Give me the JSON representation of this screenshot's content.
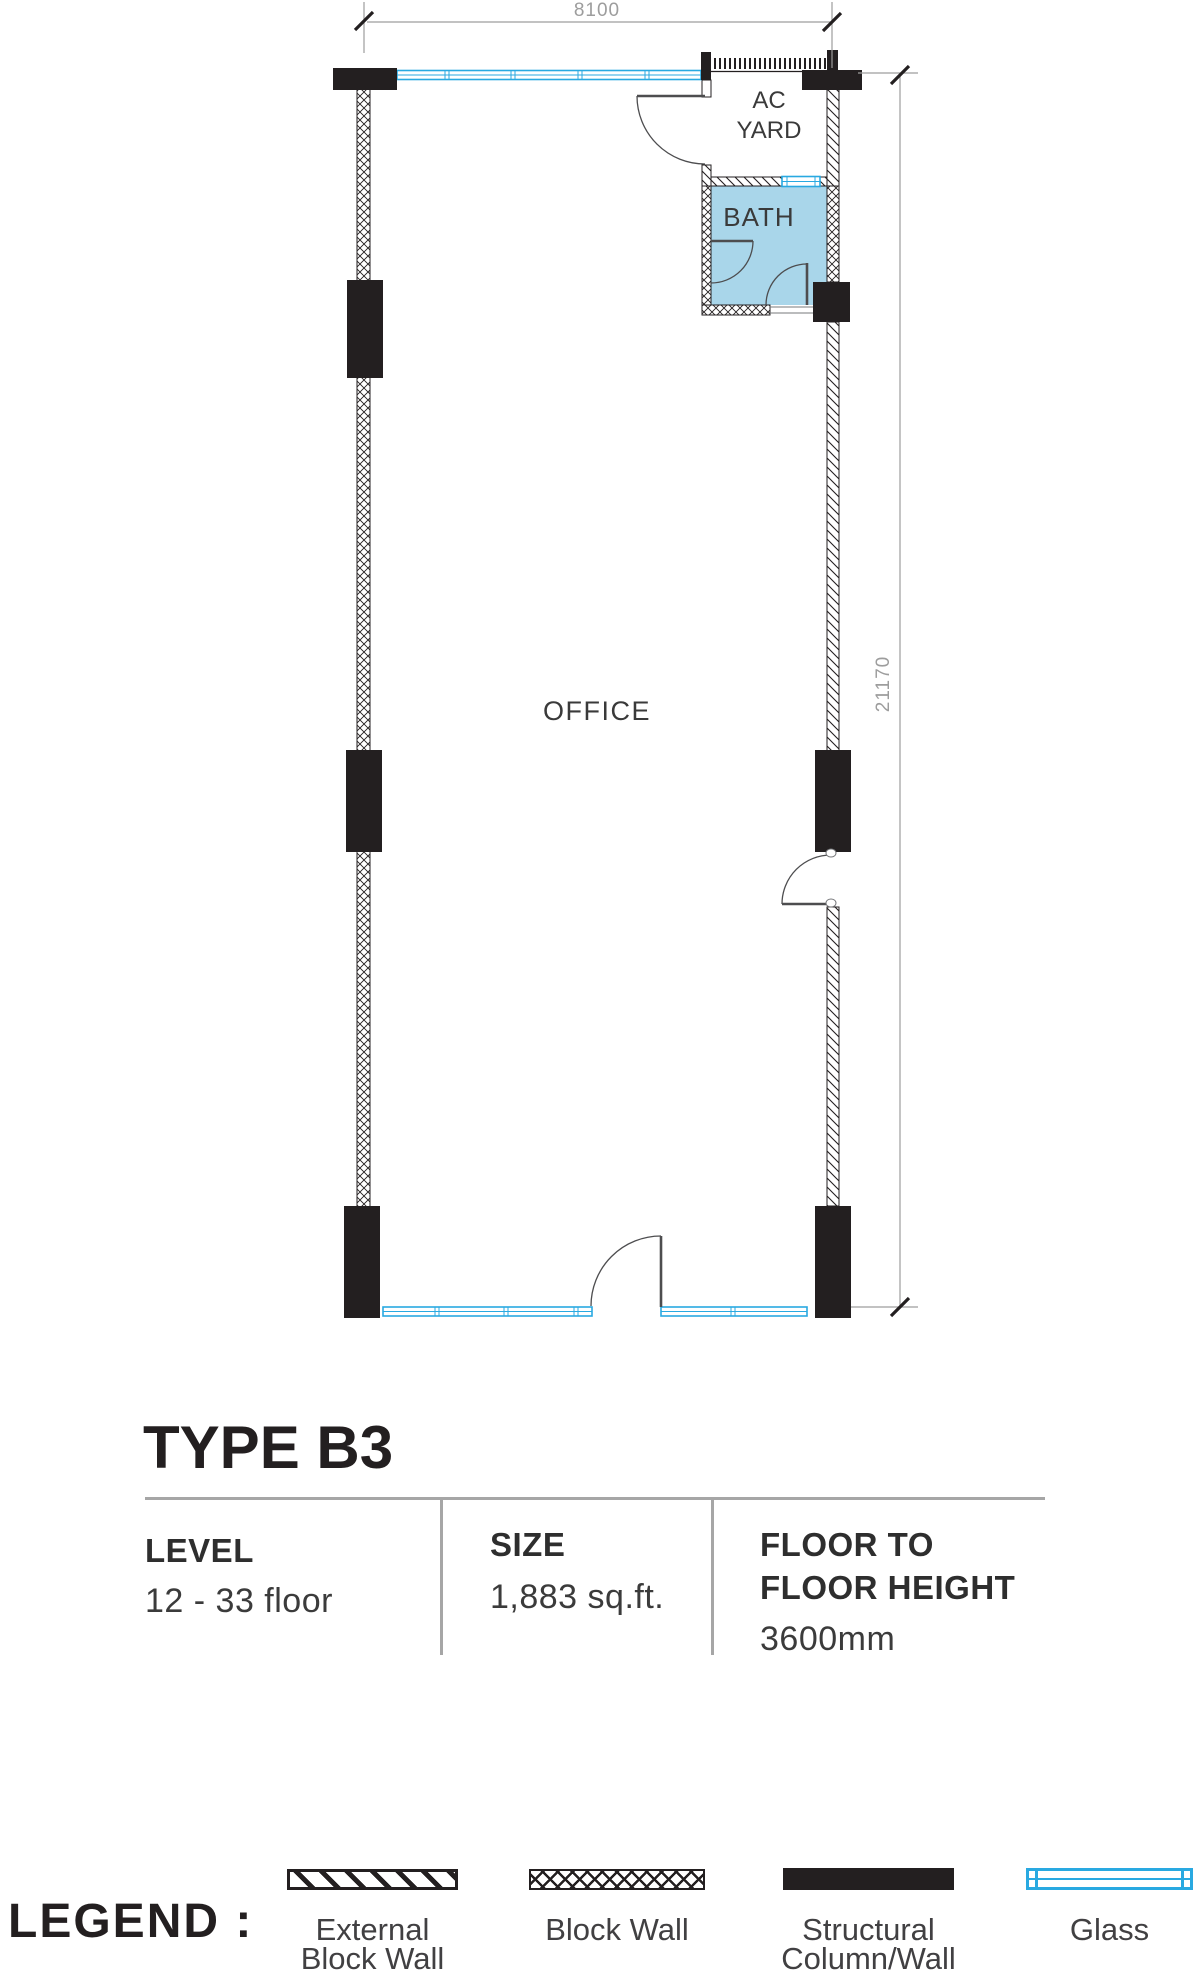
{
  "plan": {
    "rooms": {
      "office": "OFFICE",
      "bath": "BATH",
      "ac_yard": "AC\nYARD"
    },
    "dimensions": {
      "width_mm": "8100",
      "height_mm": "21170"
    }
  },
  "info": {
    "title": "TYPE B3",
    "columns": [
      {
        "label": "LEVEL",
        "value": "12 - 33 floor"
      },
      {
        "label": "SIZE",
        "value": "1,883 sq.ft."
      },
      {
        "label": "FLOOR TO\nFLOOR HEIGHT",
        "value": "3600mm"
      }
    ]
  },
  "legend": {
    "title": "LEGEND :",
    "items": [
      {
        "name": "external-block-wall",
        "label": "External\nBlock Wall"
      },
      {
        "name": "block-wall",
        "label": "Block Wall"
      },
      {
        "name": "structural-column-wall",
        "label": "Structural\nColumn/Wall"
      },
      {
        "name": "glass",
        "label": "Glass"
      }
    ]
  },
  "colors": {
    "glass": "#29A9E1",
    "bath_fill": "#A9D6EA",
    "wall_black": "#231F20",
    "dimension_gray": "#9D9D9D",
    "divider_gray": "#A6A6A6",
    "text_dark": "#3B3B3B"
  }
}
